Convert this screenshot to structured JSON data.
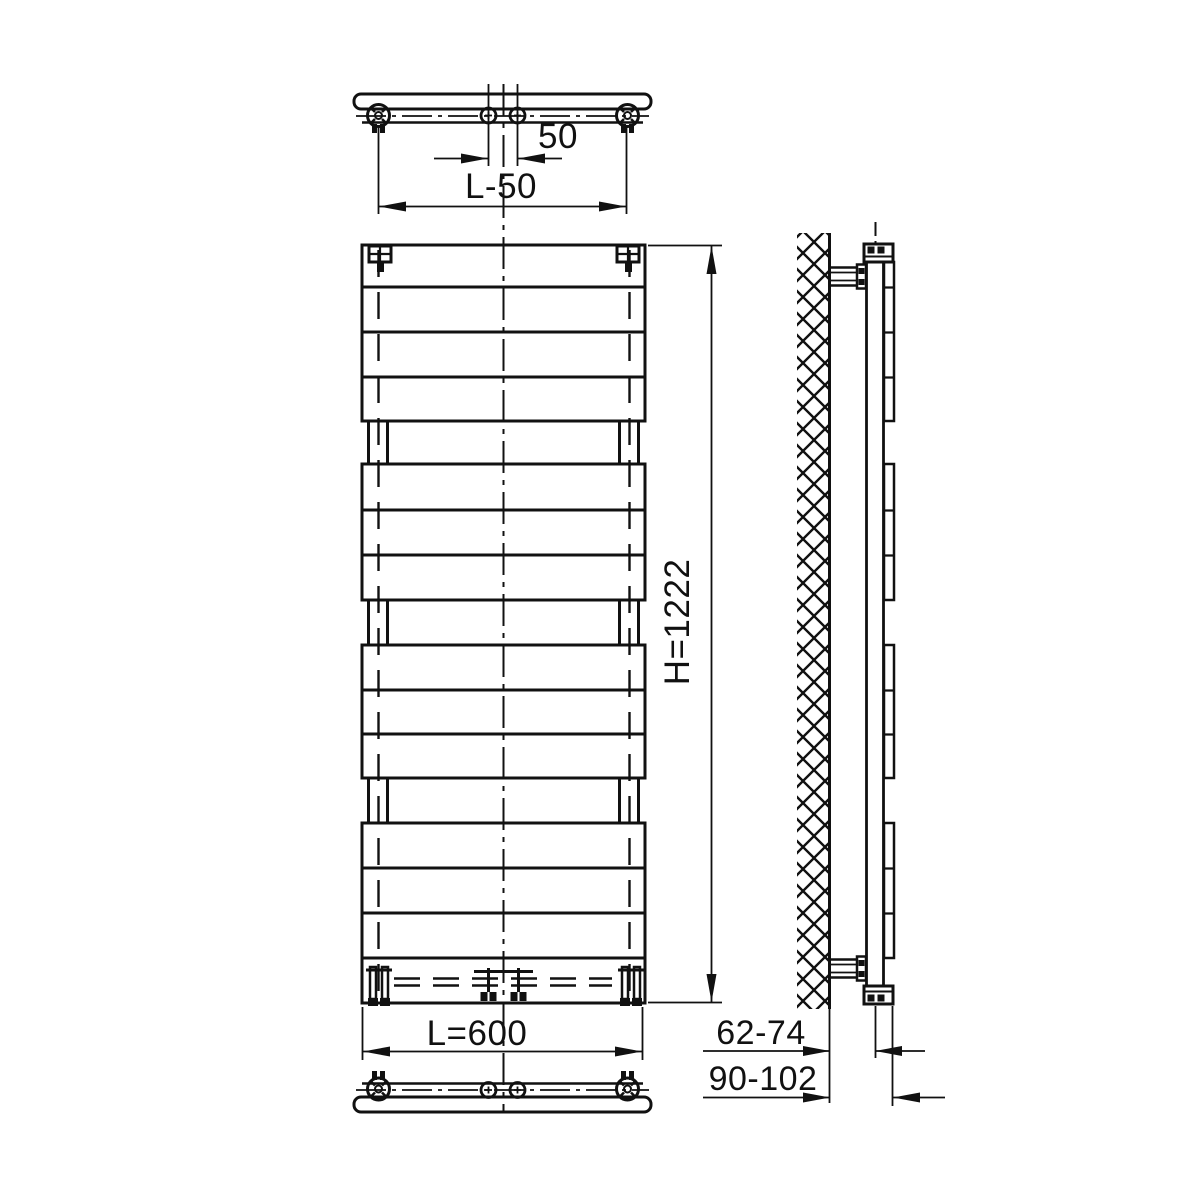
{
  "drawing": {
    "labels": {
      "port_spacing": "50",
      "bracket_spacing": "L-50",
      "height": "H=1222",
      "width": "L=600",
      "wall_to_back": "62-74",
      "wall_to_front": "90-102"
    },
    "colors": {
      "line": "#111111",
      "background": "#ffffff"
    }
  }
}
